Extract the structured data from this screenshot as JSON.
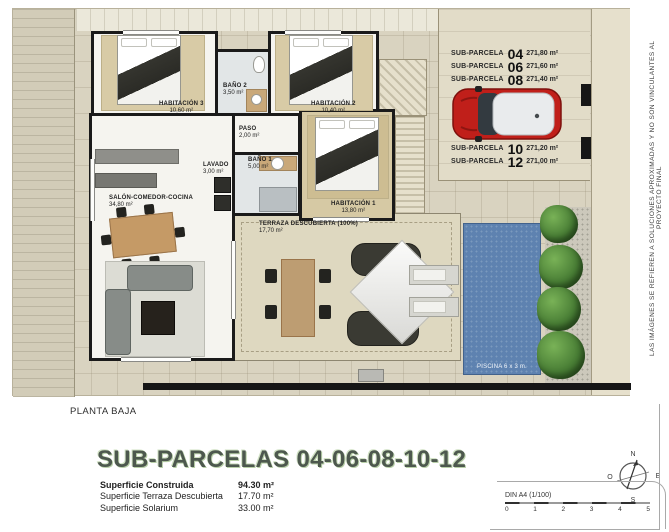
{
  "plan": {
    "floor_label": "PLANTA BAJA",
    "disclaimer": "LAS IMÁGENES SE REFIEREN A SOLUCIONES APROXIMADAS Y NO SON VINCULANTES AL PROYECTO FINAL",
    "rooms": [
      {
        "name": "HABITACIÓN 3",
        "area": "10,60 m²"
      },
      {
        "name": "BAÑO 2",
        "area": "3,50 m²"
      },
      {
        "name": "HABITACIÓN 2",
        "area": "10,40 m²"
      },
      {
        "name": "PASO",
        "area": "2,00 m²"
      },
      {
        "name": "LAVADO",
        "area": "3,00 m²"
      },
      {
        "name": "BAÑO 1",
        "area": "5,00 m²"
      },
      {
        "name": "HABITACIÓN 1",
        "area": "13,80 m²"
      },
      {
        "name": "SALÓN-COMEDOR-COCINA",
        "area": "34,80 m²"
      },
      {
        "name": "TERRAZA DESCUBIERTA (100%)",
        "area": "17,70 m²"
      }
    ],
    "pool_label": "PISCINA 6 x 3 m.",
    "legend_items": [
      {
        "label": "SUB-PARCELA",
        "number": "04",
        "area": "271,80 m²"
      },
      {
        "label": "SUB-PARCELA",
        "number": "06",
        "area": "271,60 m²"
      },
      {
        "label": "SUB-PARCELA",
        "number": "08",
        "area": "271,40 m²"
      },
      {
        "label": "SUB-PARCELA",
        "number": "10",
        "area": "271,20 m²"
      },
      {
        "label": "SUB-PARCELA",
        "number": "12",
        "area": "271,00 m²"
      }
    ]
  },
  "footer": {
    "title": "SUB-PARCELAS 04-06-08-10-12",
    "surfaces": [
      {
        "label": "Superficie Construida",
        "value": "94.30 m²"
      },
      {
        "label": "Superficie Terraza Descubierta",
        "value": "17.70 m²"
      },
      {
        "label": "Superficie Solarium",
        "value": "33.00 m²"
      }
    ],
    "scale_label": "DIN A4 (1/100)",
    "scale_ticks": [
      "0",
      "1",
      "2",
      "3",
      "4",
      "5"
    ],
    "compass": {
      "north": "N",
      "east": "E",
      "south": "S",
      "west": "O"
    }
  },
  "colors": {
    "title_green": "#4d584e",
    "pool_blue": "#5e82b0",
    "car_red": "#c01f1a",
    "plan_background": "#d9d3c0"
  }
}
